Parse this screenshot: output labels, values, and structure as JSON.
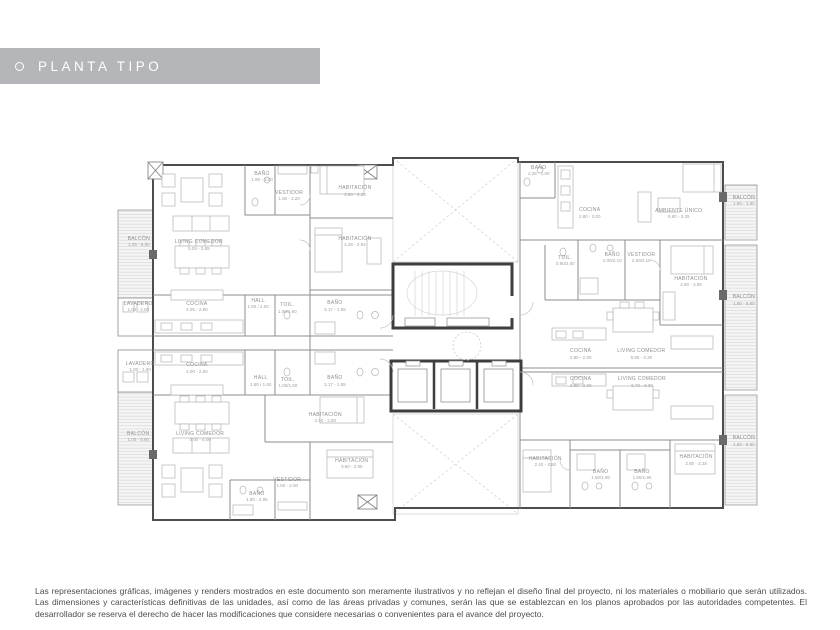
{
  "banner": {
    "title": "PLANTA TIPO",
    "bg_color": "#b5b6ba",
    "text_color": "#ffffff"
  },
  "disclaimer": "Las representaciones gráficas, imágenes y renders mostrados en este documento son meramente ilustrativos y no reflejan el diseño final del proyecto, ni los materiales o mobiliario que serán utilizados. Las dimensiones y características definitivas de las unidades, así como de las áreas privadas y comunes, serán las que se establezcan en los planos aprobados por las autoridades competentes. El desarrollador se reserva el derecho de hacer las modificaciones que considere necesarias o convenientes para el avance del proyecto.",
  "colors": {
    "wall": "#4d4d4d",
    "core_wall": "#3e3e3e",
    "label": "#8f8f8f",
    "hatch": "#d0d0d0"
  },
  "plan": {
    "rooms": [
      {
        "name": "BALCÓN",
        "dims": "1.05 - 8.90",
        "x": 3.7,
        "y": 24.2
      },
      {
        "name": "LAVADERO",
        "dims": "1.00 - 2.00",
        "x": 3.6,
        "y": 41.3
      },
      {
        "name": "LAVADERO",
        "dims": "1.00 - 1.90",
        "x": 3.9,
        "y": 57.1
      },
      {
        "name": "BALCÓN",
        "dims": "1.00 - 8.90",
        "x": 3.6,
        "y": 75.5
      },
      {
        "name": "BAÑO",
        "dims": "1.90 - 3.00",
        "x": 22.8,
        "y": 7.1
      },
      {
        "name": "VESTIDOR",
        "dims": "1.60 - 2.20",
        "x": 27.0,
        "y": 12.1
      },
      {
        "name": "HABITACIÓN",
        "dims": "3.80 - 3.28",
        "x": 37.2,
        "y": 10.8
      },
      {
        "name": "HABITACIÓN",
        "dims": "4.28 - 2.84",
        "x": 37.2,
        "y": 24.2
      },
      {
        "name": "LIVING COMEDOR",
        "dims": "5.05 - 3.85",
        "x": 13.0,
        "y": 25.0
      },
      {
        "name": "COCINA",
        "dims": "4.05 - 2.80",
        "x": 12.7,
        "y": 41.3
      },
      {
        "name": "HALL",
        "dims": "1.80 / 2.00",
        "x": 22.2,
        "y": 40.5
      },
      {
        "name": "TOIL.",
        "dims": "1.00/1.60",
        "x": 26.7,
        "y": 41.6
      },
      {
        "name": "BAÑO",
        "dims": "3.17 - 1.85",
        "x": 34.1,
        "y": 41.1
      },
      {
        "name": "COCINA",
        "dims": "4.00 - 2.80",
        "x": 12.7,
        "y": 57.4
      },
      {
        "name": "HALL",
        "dims": "1.80 / 1.60",
        "x": 22.6,
        "y": 60.8
      },
      {
        "name": "TOIL.",
        "dims": "1.00/1.60",
        "x": 26.8,
        "y": 61.3
      },
      {
        "name": "BAÑO",
        "dims": "3.17 - 1.85",
        "x": 34.1,
        "y": 60.8
      },
      {
        "name": "LIVING COMEDOR",
        "dims": "4.00 - 5.00",
        "x": 13.2,
        "y": 75.5
      },
      {
        "name": "HABITACIÓN",
        "dims": "4.10 - 2.80",
        "x": 32.6,
        "y": 70.5
      },
      {
        "name": "HABITACIÓN",
        "dims": "3.60 - 2.95",
        "x": 36.7,
        "y": 82.6
      },
      {
        "name": "VESTIDOR",
        "dims": "1.60 - 2.00",
        "x": 26.7,
        "y": 87.6
      },
      {
        "name": "BAÑO",
        "dims": "1.90 - 2.95",
        "x": 22.0,
        "y": 91.3
      },
      {
        "name": "BAÑO",
        "dims": "2.26 - 1.00",
        "x": 65.7,
        "y": 5.5
      },
      {
        "name": "COCINA",
        "dims": "2.80 - 2.00",
        "x": 73.6,
        "y": 16.6
      },
      {
        "name": "AMBIENTE ÚNICO",
        "dims": "5.80 - 3.25",
        "x": 87.4,
        "y": 16.8
      },
      {
        "name": "BALCÓN",
        "dims": "1.90 - 1.90",
        "x": 97.5,
        "y": 13.4
      },
      {
        "name": "TOIL.",
        "dims": "0.90/2.00",
        "x": 69.8,
        "y": 29.2
      },
      {
        "name": "BAÑO",
        "dims": "2.00/2.10",
        "x": 77.1,
        "y": 28.4
      },
      {
        "name": "VESTIDOR",
        "dims": "2.00/2.10",
        "x": 81.6,
        "y": 28.4
      },
      {
        "name": "HABITACIÓN",
        "dims": "2.80 - 3.55",
        "x": 89.3,
        "y": 34.7
      },
      {
        "name": "BALCÓN",
        "dims": "1.80 - 8.90",
        "x": 97.5,
        "y": 39.5
      },
      {
        "name": "COCINA",
        "dims": "2.80 - 2.00",
        "x": 72.2,
        "y": 53.7
      },
      {
        "name": "LIVING COMEDOR",
        "dims": "5.90 - 3.30",
        "x": 81.6,
        "y": 53.7
      },
      {
        "name": "COCINA",
        "dims": "2.80 - 2.00",
        "x": 72.2,
        "y": 61.1
      },
      {
        "name": "LIVING COMEDOR",
        "dims": "6.70 - 3.30",
        "x": 81.7,
        "y": 61.1
      },
      {
        "name": "BALCÓN",
        "dims": "1.80 - 8.90",
        "x": 97.5,
        "y": 76.6
      },
      {
        "name": "HABITACIÓN",
        "dims": "2.40 - 3.80",
        "x": 66.7,
        "y": 82.1
      },
      {
        "name": "BAÑO",
        "dims": "1.60/1.90",
        "x": 75.3,
        "y": 85.5
      },
      {
        "name": "BAÑO",
        "dims": "1.60/1.90",
        "x": 81.7,
        "y": 85.5
      },
      {
        "name": "HABITACIÓN",
        "dims": "2.80 - 3.28",
        "x": 90.1,
        "y": 81.6
      }
    ]
  }
}
